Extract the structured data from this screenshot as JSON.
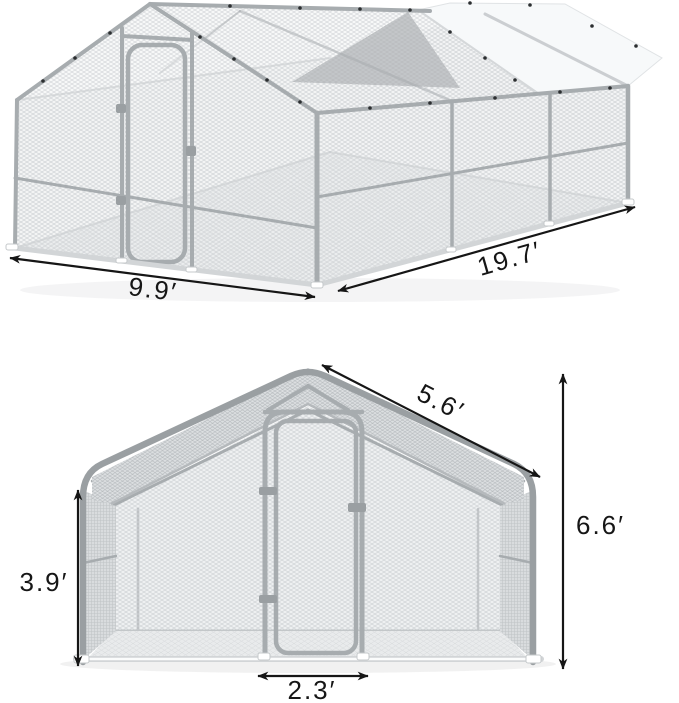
{
  "image": {
    "description": "Dimension diagram of a walk-in galvanized metal chicken coop run with hexagonal wire mesh walls, a lockable front door and a partial white roof tarp, shown in an isometric view (top) and a front view (bottom)",
    "background": "#ffffff"
  },
  "views": {
    "iso": {
      "name": "isometric-view",
      "dimensions": {
        "width": "9.9′",
        "length": "19.7′"
      }
    },
    "front": {
      "name": "front-view",
      "dimensions": {
        "roof_slope": "5.6′",
        "total_height": "6.6′",
        "wall_height": "3.9′",
        "door_width": "2.3′"
      }
    }
  },
  "colors": {
    "dim": "#161616",
    "frame": "#a7acaf",
    "frame_dark": "#9a9fa2",
    "tarp": "#f7f9fa",
    "tarp_underside": "#888c8f",
    "base_bar": "#d2d5d7",
    "mesh_line": "#c9cdd0"
  }
}
